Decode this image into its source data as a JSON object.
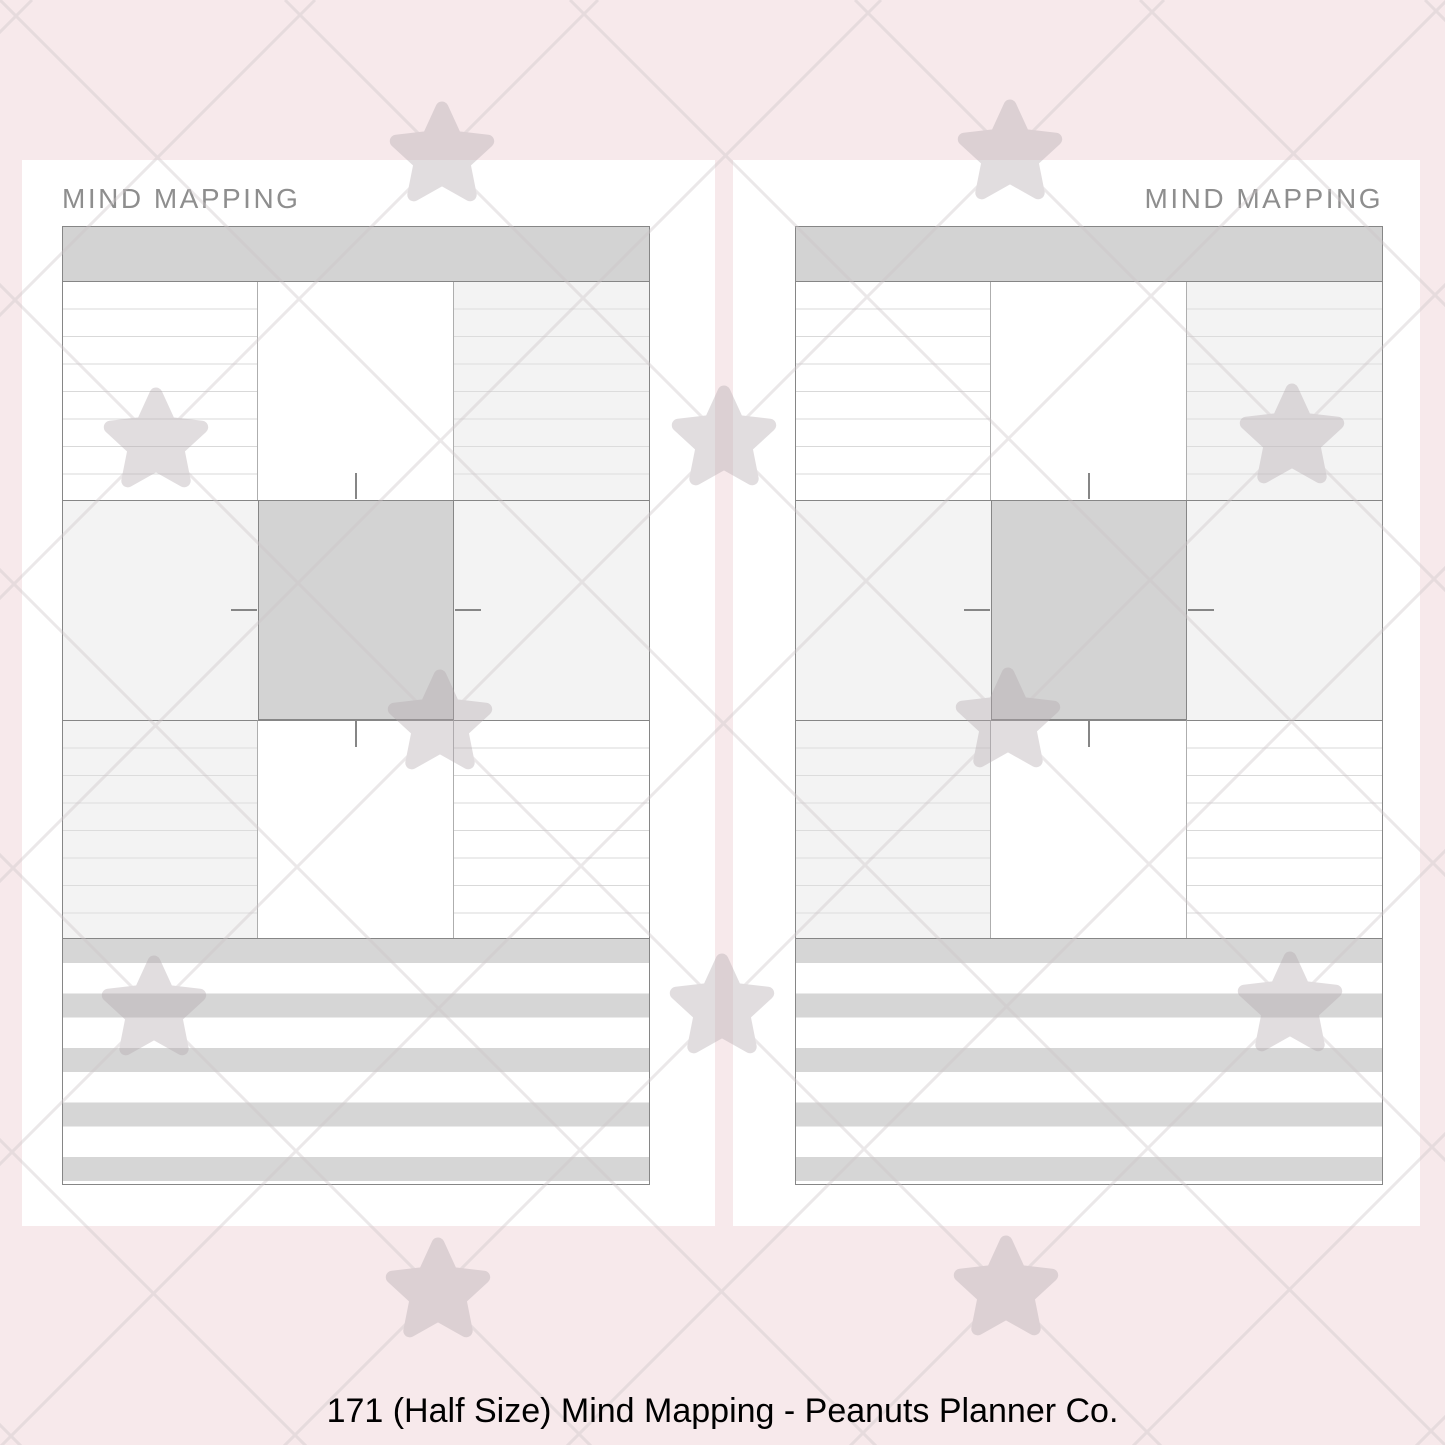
{
  "meta": {
    "caption": "171 (Half Size) Mind Mapping - Peanuts Planner Co."
  },
  "pages": [
    {
      "id": "left",
      "title": "MIND MAPPING",
      "title_align": "left"
    },
    {
      "id": "right",
      "title": "MIND MAPPING",
      "title_align": "right"
    }
  ],
  "watermark": {
    "icon": "star-watermark-icon",
    "opacity": 0.38
  },
  "colors": {
    "canvas_bg": "#f7e9eb",
    "page_bg": "#ffffff",
    "banner_fill": "#d3d3d3",
    "center_box_fill": "#d3d3d3",
    "cell_tint": "#f3f3f3",
    "rule_on_white": "#d9d9d9",
    "rule_on_tint": "#dcdcdc",
    "grid_border": "#868686",
    "divider": "#aeaeae",
    "stripe_gray": "#d6d6d6",
    "title_color": "#8e8e8e",
    "caption_color": "#000000",
    "watermark_star": "#b3a8ae",
    "watermark_line": "#cdc5c8",
    "wm_opacity": "0.38"
  }
}
